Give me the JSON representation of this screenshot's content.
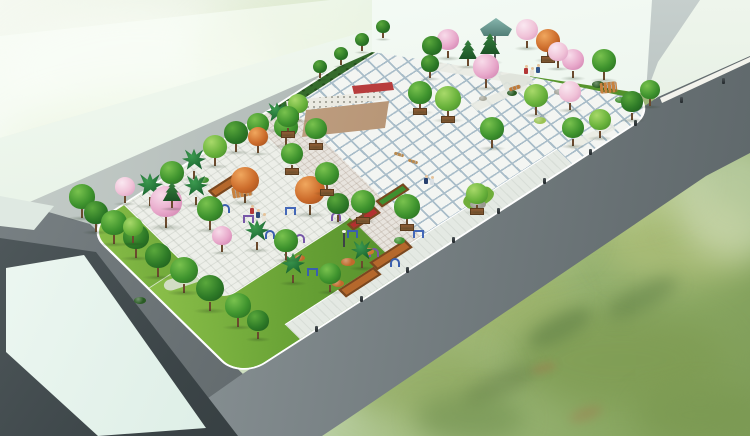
{
  "scene": {
    "description": "Bird's-eye architectural rendering of a landscaped public plaza park: tiled central square, garden with blossom trees, outdoor fitness area, lawns, perimeter roads, and surrounding abstract buildings over a painterly green meadow.",
    "palette": {
      "meadow_green": "#8aa55e",
      "mist_green": "#eef4e6",
      "road_gray": "#6f787b",
      "road_dark": "#525a5d",
      "building_glass": "#ddeee6",
      "building_white": "#eef5ec",
      "building_dark_face": "#3c4548",
      "plaza_tile": "#f3f5f2",
      "tile_grout": "#a9bdc9",
      "lawn_green": "#68a235",
      "hedge_green": "#356b2c",
      "stage_tan": "#b3906f",
      "tree_green_dark": "#2e7b27",
      "tree_green_mid": "#3f942e",
      "tree_green_light": "#6ab33c",
      "tree_pink": "#e8a9cb",
      "tree_orange": "#cd6d2c",
      "palm_green": "#1d6b33",
      "conifer_green": "#1f5f2a",
      "equipment_blue": "#3a5fae",
      "equipment_purple": "#7757a8",
      "planter_brown": "#8a5a33",
      "flower_red": "#b33030",
      "pavilion_teal": "#6fa39b"
    },
    "trees": [
      [
        150,
        206,
        13,
        "pm",
        0
      ],
      [
        172,
        192,
        12,
        "g2",
        0
      ],
      [
        194,
        179,
        12,
        "pm",
        0
      ],
      [
        215,
        166,
        12,
        "g3",
        0
      ],
      [
        236,
        152,
        12,
        "g1",
        0
      ],
      [
        258,
        142,
        11,
        "g2",
        0
      ],
      [
        277,
        130,
        11,
        "pm",
        0
      ],
      [
        298,
        120,
        10,
        "g3",
        0
      ],
      [
        320,
        78,
        7,
        "g1",
        0
      ],
      [
        341,
        65,
        7,
        "g1",
        0
      ],
      [
        362,
        51,
        7,
        "g1",
        0
      ],
      [
        383,
        38,
        7,
        "g1",
        0
      ],
      [
        258,
        153,
        10,
        "or",
        0
      ],
      [
        286,
        146,
        12,
        "g2",
        0
      ],
      [
        82,
        218,
        13,
        "g2",
        0
      ],
      [
        96,
        232,
        12,
        "g1",
        0
      ],
      [
        114,
        244,
        13,
        "g2",
        0
      ],
      [
        125,
        203,
        10,
        "pk2",
        0
      ],
      [
        136,
        258,
        13,
        "g1",
        0
      ],
      [
        166,
        228,
        16,
        "pk",
        0
      ],
      [
        172,
        208,
        10,
        "cf",
        0
      ],
      [
        133,
        243,
        10,
        "g3",
        0
      ],
      [
        158,
        277,
        13,
        "g1",
        0
      ],
      [
        184,
        293,
        14,
        "g2",
        0
      ],
      [
        210,
        311,
        14,
        "g1",
        0
      ],
      [
        238,
        327,
        13,
        "g2",
        0
      ],
      [
        258,
        339,
        11,
        "g1",
        0
      ],
      [
        196,
        205,
        12,
        "pm",
        0
      ],
      [
        245,
        203,
        14,
        "or",
        0
      ],
      [
        210,
        230,
        13,
        "g2",
        0
      ],
      [
        310,
        215,
        15,
        "or",
        0
      ],
      [
        257,
        250,
        12,
        "pm",
        0
      ],
      [
        293,
        283,
        12,
        "pm",
        0
      ],
      [
        362,
        268,
        11,
        "pm",
        0
      ],
      [
        338,
        222,
        11,
        "g1",
        0
      ],
      [
        286,
        260,
        12,
        "g2",
        0
      ],
      [
        330,
        292,
        11,
        "g2",
        0
      ],
      [
        222,
        252,
        10,
        "pk",
        0
      ],
      [
        288,
        135,
        11,
        "g2",
        1
      ],
      [
        316,
        147,
        11,
        "g2",
        1
      ],
      [
        292,
        172,
        11,
        "g2",
        1
      ],
      [
        327,
        193,
        12,
        "g2",
        1
      ],
      [
        363,
        221,
        12,
        "g2",
        1
      ],
      [
        407,
        228,
        13,
        "g2",
        1
      ],
      [
        477,
        212,
        11,
        "g3",
        1
      ],
      [
        420,
        112,
        12,
        "g2",
        1
      ],
      [
        448,
        120,
        13,
        "g3",
        1
      ],
      [
        492,
        148,
        12,
        "g2",
        0
      ],
      [
        448,
        58,
        11,
        "pk",
        0
      ],
      [
        432,
        62,
        10,
        "g1",
        0
      ],
      [
        468,
        66,
        10,
        "cf",
        0
      ],
      [
        490,
        62,
        11,
        "cf",
        0
      ],
      [
        527,
        48,
        11,
        "pk2",
        0
      ],
      [
        548,
        60,
        12,
        "or",
        1
      ],
      [
        486,
        88,
        13,
        "pk",
        0
      ],
      [
        573,
        78,
        11,
        "pk",
        0
      ],
      [
        570,
        110,
        11,
        "pk2",
        0
      ],
      [
        536,
        115,
        12,
        "g3",
        0
      ],
      [
        604,
        80,
        12,
        "g2",
        0
      ],
      [
        573,
        146,
        11,
        "g2",
        0
      ],
      [
        600,
        138,
        11,
        "g3",
        0
      ],
      [
        632,
        120,
        11,
        "g1",
        0
      ],
      [
        650,
        106,
        10,
        "g2",
        0
      ],
      [
        430,
        78,
        9,
        "g1",
        0
      ],
      [
        558,
        68,
        10,
        "pk2",
        0
      ]
    ],
    "people": [
      [
        424,
        184,
        "#27406e"
      ],
      [
        430,
        185,
        "#d8dfe4"
      ],
      [
        250,
        214,
        "#b33636"
      ],
      [
        256,
        218,
        "#2c4a78"
      ],
      [
        262,
        222,
        "#e8e4da"
      ],
      [
        301,
        186,
        "#3a6ea8"
      ],
      [
        307,
        190,
        "#e8e4da"
      ],
      [
        524,
        74,
        "#b33636"
      ],
      [
        530,
        76,
        "#e8e4da"
      ],
      [
        536,
        73,
        "#31558a"
      ]
    ],
    "equipment": [
      [
        225,
        212,
        "a",
        "#3a5fae"
      ],
      [
        248,
        223,
        "b",
        "#7757a8"
      ],
      [
        270,
        238,
        "a",
        "#3a5fae"
      ],
      [
        290,
        215,
        "b",
        "#4468b8"
      ],
      [
        300,
        242,
        "a",
        "#7757a8"
      ],
      [
        312,
        276,
        "b",
        "#3a5fae"
      ],
      [
        336,
        220,
        "a",
        "#7757a8"
      ],
      [
        352,
        238,
        "b",
        "#3a5fae"
      ],
      [
        374,
        256,
        "a",
        "#7757a8"
      ],
      [
        395,
        266,
        "a",
        "#3a5fae"
      ],
      [
        418,
        238,
        "b",
        "#4468b8"
      ]
    ],
    "bollards": [
      [
        315,
        332
      ],
      [
        360,
        302
      ],
      [
        406,
        273
      ],
      [
        452,
        243
      ],
      [
        497,
        214
      ],
      [
        543,
        184
      ],
      [
        589,
        155
      ],
      [
        634,
        126
      ],
      [
        680,
        103
      ],
      [
        722,
        84
      ]
    ],
    "shrubs": [
      [
        348,
        262,
        14,
        8,
        "#c06a2c"
      ],
      [
        338,
        283,
        12,
        7,
        "#c06a2c"
      ],
      [
        368,
        251,
        12,
        7,
        "#cc7a30"
      ],
      [
        399,
        240,
        11,
        7,
        "#3f8f2f"
      ],
      [
        512,
        93,
        10,
        6,
        "#2a5c24"
      ],
      [
        598,
        84,
        12,
        7,
        "#2a5c24"
      ],
      [
        620,
        100,
        10,
        6,
        "#3f8f2f"
      ],
      [
        540,
        120,
        12,
        7,
        "#9ac352"
      ],
      [
        140,
        300,
        12,
        7,
        "#2a5c24"
      ],
      [
        204,
        180,
        10,
        6,
        "#3f8f2f"
      ],
      [
        300,
        258,
        10,
        6,
        "#c06a2c"
      ],
      [
        478,
        204,
        16,
        9,
        "#9a9a90"
      ],
      [
        560,
        92,
        12,
        6,
        "#a0a096"
      ],
      [
        483,
        98,
        8,
        5,
        "#a8a89c"
      ]
    ],
    "furniture": [
      [
        394,
        153,
        10,
        3,
        "#b98a4e",
        18
      ],
      [
        408,
        160,
        10,
        3,
        "#b98a4e",
        18
      ],
      [
        509,
        86,
        12,
        4,
        "#c07a38",
        -18
      ],
      [
        600,
        82,
        17,
        11,
        "#c8823f",
        -6
      ],
      [
        232,
        186,
        20,
        11,
        "#c8823f",
        -10
      ]
    ],
    "meadow_patches": [
      [
        480,
        300,
        180,
        90,
        "#9db36a",
        0.75,
        0,
        16
      ],
      [
        620,
        360,
        220,
        100,
        "#7e9b52",
        0.8,
        0,
        18
      ],
      [
        420,
        380,
        160,
        80,
        "#8fa85e",
        0.7,
        0,
        16
      ],
      [
        680,
        240,
        160,
        90,
        "#b3c27c",
        0.65,
        0,
        16
      ],
      [
        600,
        180,
        200,
        80,
        "#cbd9a4",
        0.6,
        0,
        16
      ],
      [
        520,
        235,
        140,
        70,
        "#a9bd72",
        0.65,
        0,
        14
      ],
      [
        560,
        328,
        70,
        24,
        "#5f7f46",
        0.55,
        -28,
        7
      ],
      [
        642,
        298,
        80,
        24,
        "#5f7f46",
        0.5,
        -28,
        8
      ],
      [
        500,
        385,
        80,
        24,
        "#647f48",
        0.5,
        -25,
        8
      ],
      [
        700,
        415,
        130,
        60,
        "#7a9850",
        0.7,
        0,
        14
      ],
      [
        470,
        418,
        110,
        50,
        "#6f8f4e",
        0.6,
        0,
        12
      ],
      [
        586,
        414,
        34,
        12,
        "#b06848",
        0.3,
        -20,
        5
      ],
      [
        544,
        368,
        26,
        10,
        "#b06848",
        0.28,
        -15,
        4
      ],
      [
        430,
        150,
        430,
        80,
        "#ffffff",
        0.16,
        -27,
        14
      ],
      [
        735,
        200,
        120,
        120,
        "#dfe9d2",
        0.5,
        0,
        16
      ]
    ],
    "mist_patches": [
      [
        140,
        70,
        280,
        130,
        "#f7fbf3",
        0.8,
        0,
        18
      ],
      [
        300,
        50,
        220,
        100,
        "#dfe8c4",
        0.4,
        0,
        16
      ],
      [
        160,
        150,
        320,
        120,
        "#cfdfa8",
        0.35,
        0,
        18
      ],
      [
        60,
        200,
        160,
        80,
        "#eef4e6",
        0.5,
        0,
        12
      ]
    ]
  }
}
